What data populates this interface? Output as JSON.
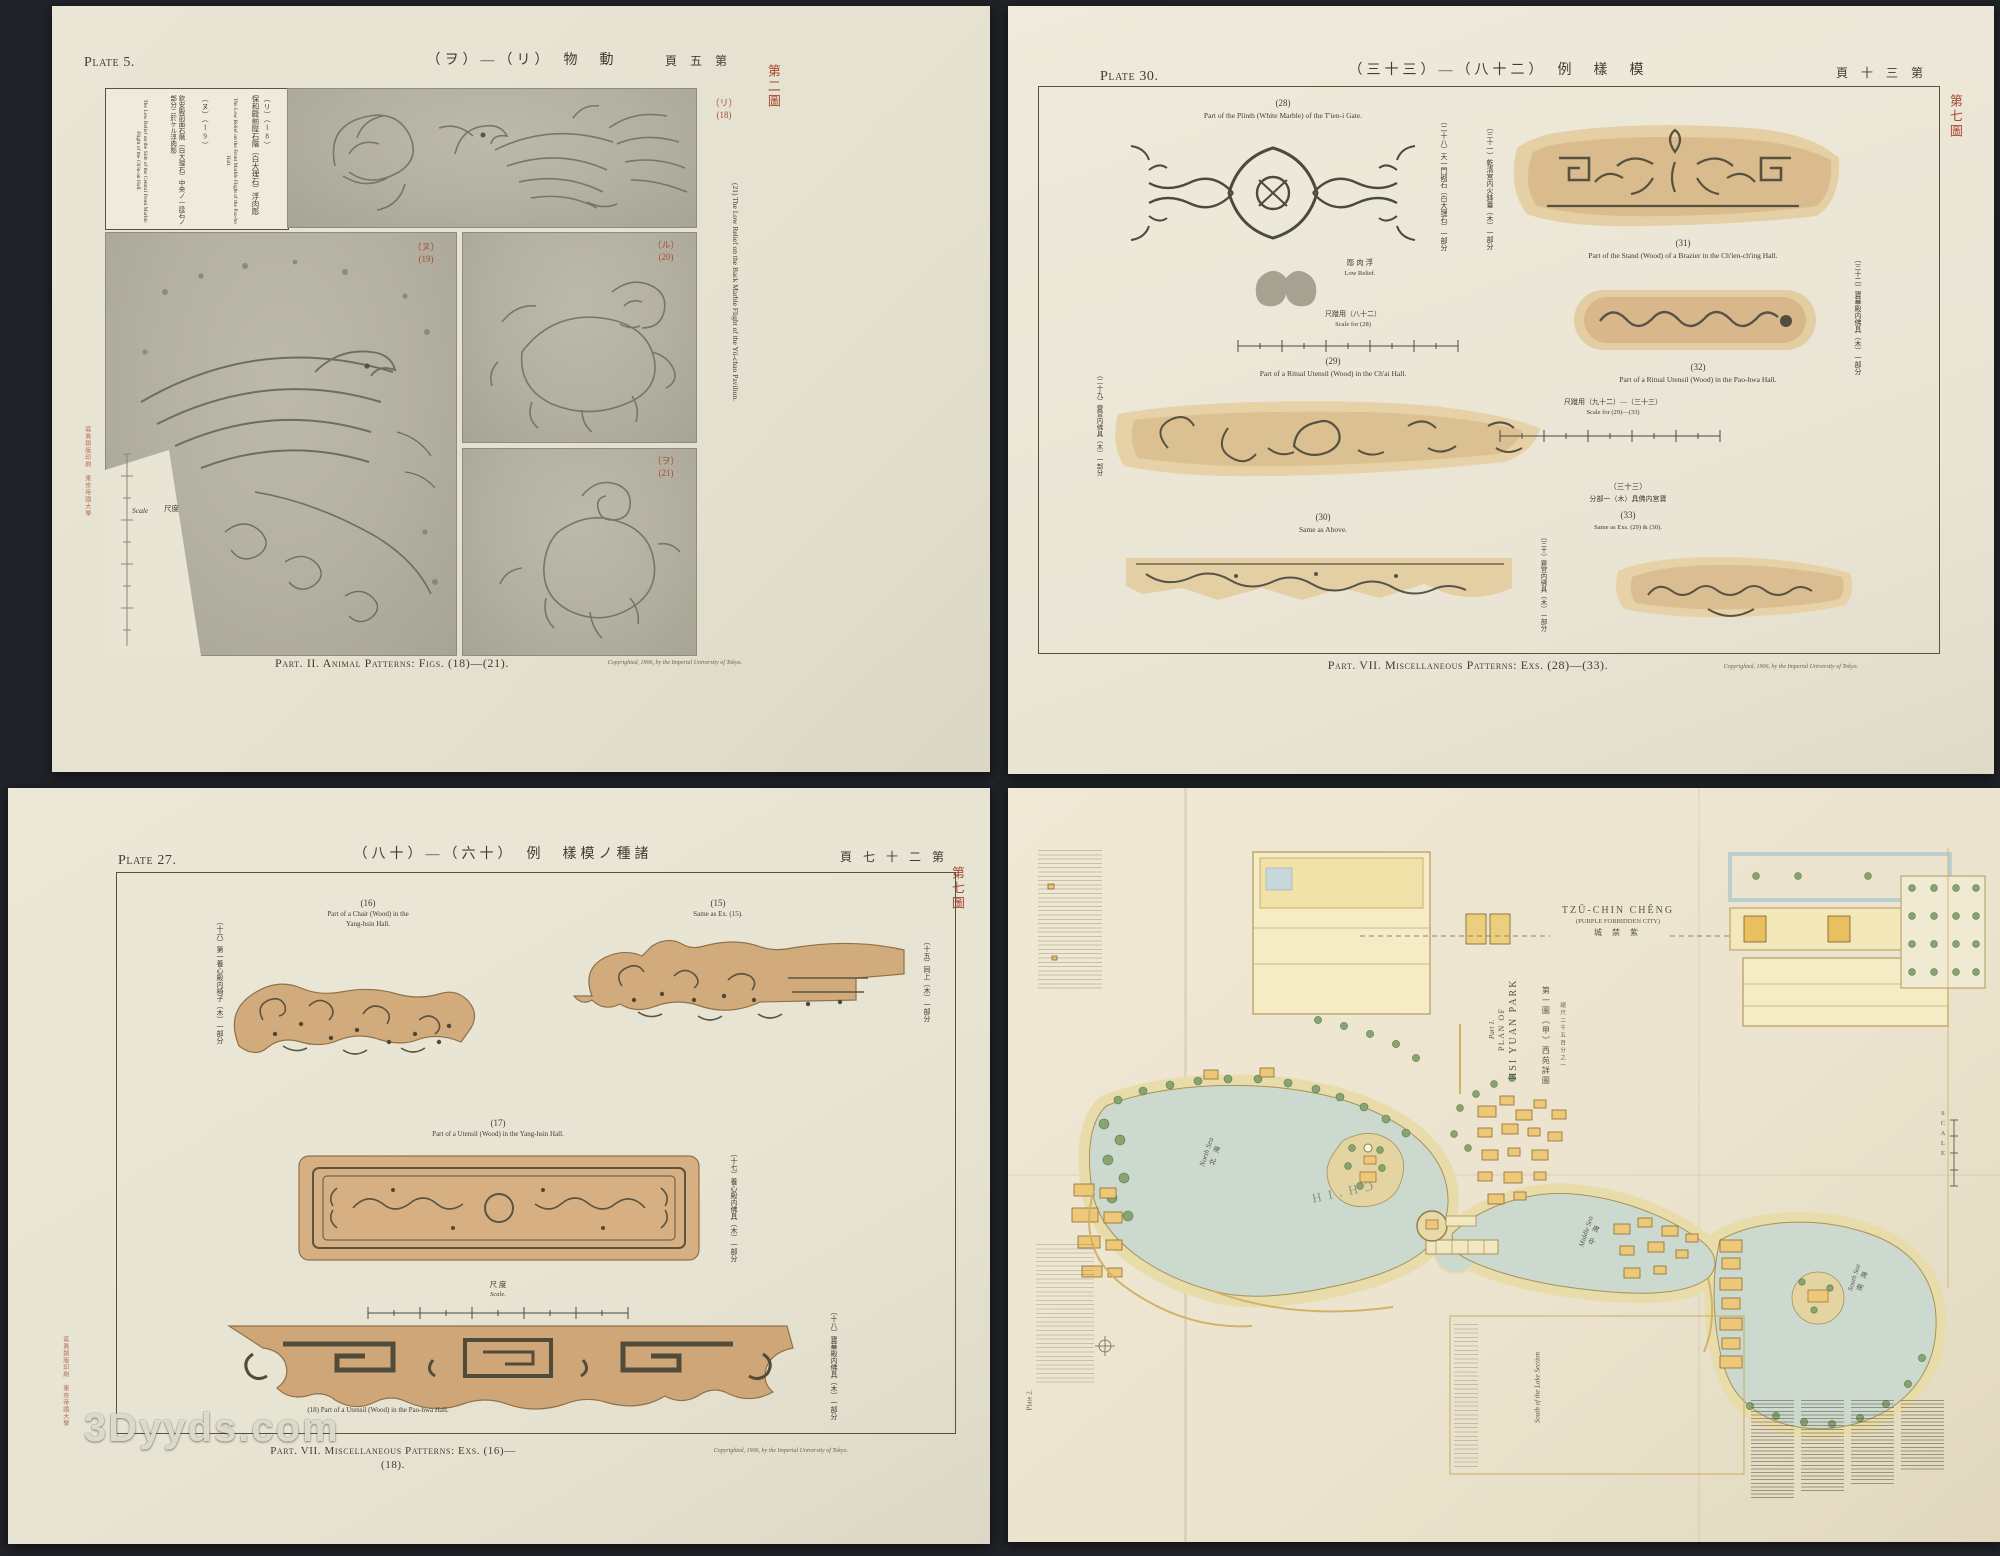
{
  "watermark": "3Dyyds.com",
  "p5": {
    "plate": "Plate 5.",
    "title": "（ヲ）―（リ）　物　動",
    "page_no": "頁 五 第",
    "fig_stamp": "第二圖",
    "cap1_num": "（リ）（18）",
    "cap1_jp": "保和殿前陛石階（白大理石）浮肉彫",
    "cap1_en": "The Low Relief on the Front Marble Flight of the Pao-ho Hall.",
    "cap2_num": "（ヌ）（19）",
    "cap2_jp": "欽安殿前面石階（白大理石）中央ノ一段石ノ部分ニ於ケル浮肉彫",
    "cap2_en": "The Low Relief on the Side of the Central Front Marble Flight of the Ch'in-an Hall.",
    "cap21": "(21)  The Low Relief on the Back Marble Flight of the Yü-chao Pavilion.",
    "f18": "（リ）\n(18)",
    "f19": "（ヌ）\n(19)",
    "f20": "（ル）\n(20)",
    "f21": "（ヲ）\n(21)",
    "scale_en": "Scale",
    "scale_jp": "尺度",
    "bottom": "Part. II.  Animal Patterns: Figs. (18)—(21).",
    "copyright": "Copyrighted, 1906, by the Imperial University of Tokyo.",
    "printer": "寫眞銅版印刷　東京帝國大學"
  },
  "p30": {
    "plate": "Plate 30.",
    "title": "（三十三）―（八十二）　例　樣　模",
    "page_no": "頁 十 三 第",
    "fig_stamp": "第七圖",
    "f28_num": "(28)",
    "f28_en": "Part of the Plinth (White Marble) of the T'ien-i Gate.",
    "f28_jp": "（二十八）天一門砌石（白大理石）一部分",
    "relief_jp": "彫 肉 浮",
    "relief_en": "Low Relief.",
    "s28_jp": "尺蹝用（八十二）",
    "s28_en": "Scale for (28)",
    "f29_num": "(29)",
    "f29_en": "Part of a Ritual Utensil (Wood) in the Ch'ai Hall.",
    "f29_jp": "（二十九）齋宮内佛具（木）一部分",
    "f30_num": "(30)",
    "f30_en": "Same as Above.",
    "f30_jp": "（三十）齋宮内佛具（木）一部分",
    "f31_num": "(31)",
    "f31_en": "Part of the Stand (Wood) of a Brazier in the Ch'ien-ch'ing Hall.",
    "f31_jp": "（三十一）乾清宮内火鉢臺（木）一部分",
    "f32_num": "(32)",
    "f32_en": "Part of a Ritual Utensil (Wood) in the Pao-hwa Hall.",
    "f32_jp": "（三十二）寶華殿内佛具（木）一部分",
    "f33_jp1": "（三十三）",
    "f33_jp2": "分部一（木）具佛内宮寶",
    "f33_num": "(33)",
    "f33_en": "Same as Exs. (29) & (30).",
    "sall_jp": "尺蹝用（九十二）―（三十三）",
    "sall_en": "Scale for (29)—(33)",
    "bottom": "Part. VII.  Miscellaneous Patterns: Exs. (28)—(33).",
    "copyright": "Copyrighted, 1906, by the Imperial University of Tokyo."
  },
  "p27": {
    "plate": "Plate 27.",
    "title": "（八十）―（六十）　例　樣模ノ種諸",
    "page_no": "頁 七 十 二 第",
    "fig_stamp": "第七圖",
    "f16_num": "(16)",
    "f16_en1": "Part of a Chair (Wood) in the",
    "f16_en2": "Yang-hsin Hall.",
    "f16_jp": "（十六）第一養心殿内椅子（木）一部分",
    "f15_num": "(15)",
    "f15_en": "Same as Ex. (15).",
    "f15_jp": "（十五）同上（木）一部分",
    "f17_num": "(17)",
    "f17_en": "Part of a Utensil (Wood) in the Yang-hsin Hall.",
    "f17_jp": "（十七）養心殿内佛具（木）一部分",
    "scale_jp": "尺 度",
    "scale_en": "Scale.",
    "f18_num": "(18)",
    "f18_en": "Part of a Utensil (Wood) in the Pao-hwa Hall.",
    "f18_jp": "（十八）寶華殿内佛具（木）一部分",
    "bottom": "Part. VII.  Miscellaneous Patterns: Exs. (16)—(18).",
    "copyright": "Copyrighted, 1906, by the Imperial University of Tokyo.",
    "printer": "寫眞銅版印刷　東京帝國大學"
  },
  "map": {
    "city1": "TZŬ-CHIN CHÊNG",
    "city2": "(PURPLE FORBIDDEN CITY)",
    "city3": "城 禁 紫",
    "part1": "Part 1.",
    "part2": "PLAN OF",
    "part3": "HSI YUAN PARK",
    "part_jp": "第一圖（甲）西苑詳圖",
    "part_scale": "縮尺二千五百分之一",
    "scale_word": "SCALE",
    "north_en": "North Sea",
    "north_jp": "北 海",
    "lake": "CH'IH",
    "middle_en": "Middle Sea",
    "middle_jp": "中 海",
    "south_en": "South Sea",
    "south_jp": "南 海",
    "section": "South of the Lake Section",
    "plate2": "Plate 2."
  }
}
